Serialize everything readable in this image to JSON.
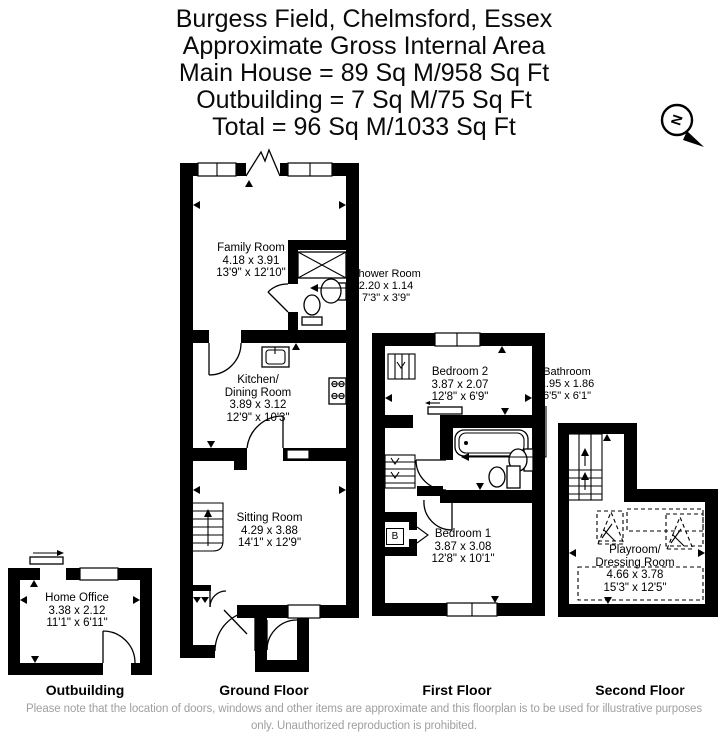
{
  "header": {
    "lines": [
      "Burgess Field, Chelmsford, Essex",
      "Approximate Gross Internal Area",
      "Main House = 89 Sq M/958 Sq Ft",
      "Outbuilding = 7 Sq M/75 Sq Ft",
      "Total = 96 Sq M/1033 Sq Ft"
    ]
  },
  "compass": {
    "north_label": "N"
  },
  "rooms": {
    "family_room": {
      "name": "Family Room",
      "metric": "4.18 x 3.91",
      "imperial": "13'9\" x 12'10\""
    },
    "shower_room": {
      "name": "Shower Room",
      "metric": "2.20 x 1.14",
      "imperial": "7'3\" x 3'9\""
    },
    "kitchen_dining": {
      "name_line1": "Kitchen/",
      "name_line2": "Dining Room",
      "metric": "3.89 x 3.12",
      "imperial": "12'9\" x 10'3\""
    },
    "sitting_room": {
      "name": "Sitting Room",
      "metric": "4.29 x 3.88",
      "imperial": "14'1\" x 12'9\""
    },
    "bedroom_2": {
      "name": "Bedroom 2",
      "metric": "3.87 x 2.07",
      "imperial": "12'8\" x 6'9\""
    },
    "bathroom": {
      "name": "Bathroom",
      "metric": "1.95 x 1.86",
      "imperial": "6'5\" x 6'1\""
    },
    "bedroom_1": {
      "name": "Bedroom 1",
      "metric": "3.87 x 3.08",
      "imperial": "12'8\" x 10'1\""
    },
    "playroom": {
      "name_line1": "Playroom/",
      "name_line2": "Dressing Room",
      "metric": "4.66 x 3.78",
      "imperial": "15'3\" x 12'5\""
    },
    "home_office": {
      "name": "Home Office",
      "metric": "3.38 x 2.12",
      "imperial": "11'1\" x 6'11\""
    }
  },
  "annotations": {
    "boiler": "B"
  },
  "floor_labels": {
    "outbuilding": "Outbuilding",
    "ground": "Ground Floor",
    "first": "First Floor",
    "second": "Second Floor"
  },
  "footer": {
    "note": "Please note that the location of doors, windows and other items are approximate and this floorplan is to be used for illustrative purposes only. Unauthorized reproduction is prohibited."
  }
}
